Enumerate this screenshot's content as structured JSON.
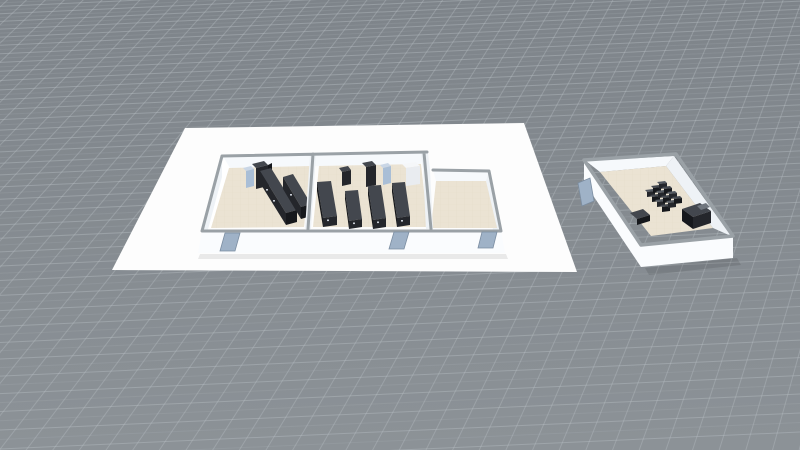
{
  "viewport": {
    "type": "3d-scene",
    "description": "Angled top-down 3D view of two white floor-plan buildings standing on an endless gray grid ground plane"
  },
  "colors": {
    "bg-top": "#7e848a",
    "bg-bottom": "#8c9297",
    "grid-line": "#b9c0c5",
    "slab": "#fdfdfd",
    "wall-bright": "#fafcfe",
    "wall-light": "#eef2f6",
    "wall-interior": "#f6f9fc",
    "wall-white": "#ffffff",
    "wall-cap": "#9aa1a6",
    "floor": "#ebe3d3",
    "floor-line": "#d9d0bd",
    "furn-dark": "#24262b",
    "furn-darker": "#16181c",
    "furn-mid": "#43474e",
    "furn-top": "#545961",
    "vend-blue": "#a9bed6",
    "vend-blue-top": "#c9d6e6",
    "fridge": "#e9ecf0",
    "fridge-top": "#f5f7f9",
    "door": "#9fb2c7",
    "label-dot": "#c9ced6"
  },
  "grid": {
    "horizontal": {
      "slope": -0.045,
      "spacing_bottom": 19,
      "spacing_top": 7,
      "opacity": 0.42,
      "sub_opacity": 0.15
    },
    "steep": {
      "vp_x": 1200,
      "vp_y": -1100,
      "spacing_bottom": 27,
      "x_start": -1150,
      "x_end": 1350,
      "opacity": 0.38
    }
  },
  "buildings": {
    "large": {
      "label": "Three-room building on white foundation slab",
      "door_count": 3,
      "rooms": [
        {
          "name": "left room",
          "items": [
            "vending machine",
            "arcade cabinet",
            "shelf row",
            "shelf row"
          ]
        },
        {
          "name": "middle room",
          "items": [
            "arcade cabinet",
            "arcade cabinet",
            "vending machine",
            "refrigerator",
            "shelf row",
            "shelf row",
            "shelf row",
            "shelf row"
          ]
        },
        {
          "name": "right room",
          "items": []
        }
      ]
    },
    "small": {
      "label": "Single-room building",
      "door_count": 1,
      "rooms": [
        {
          "name": "room",
          "items": [
            "table cluster",
            "bench",
            "desk"
          ]
        }
      ]
    }
  },
  "cluster": {
    "x": 647,
    "y": 192,
    "cols": 3,
    "rows": 4,
    "ux": 6,
    "uy": -4,
    "vx": 5,
    "vy": 5
  }
}
